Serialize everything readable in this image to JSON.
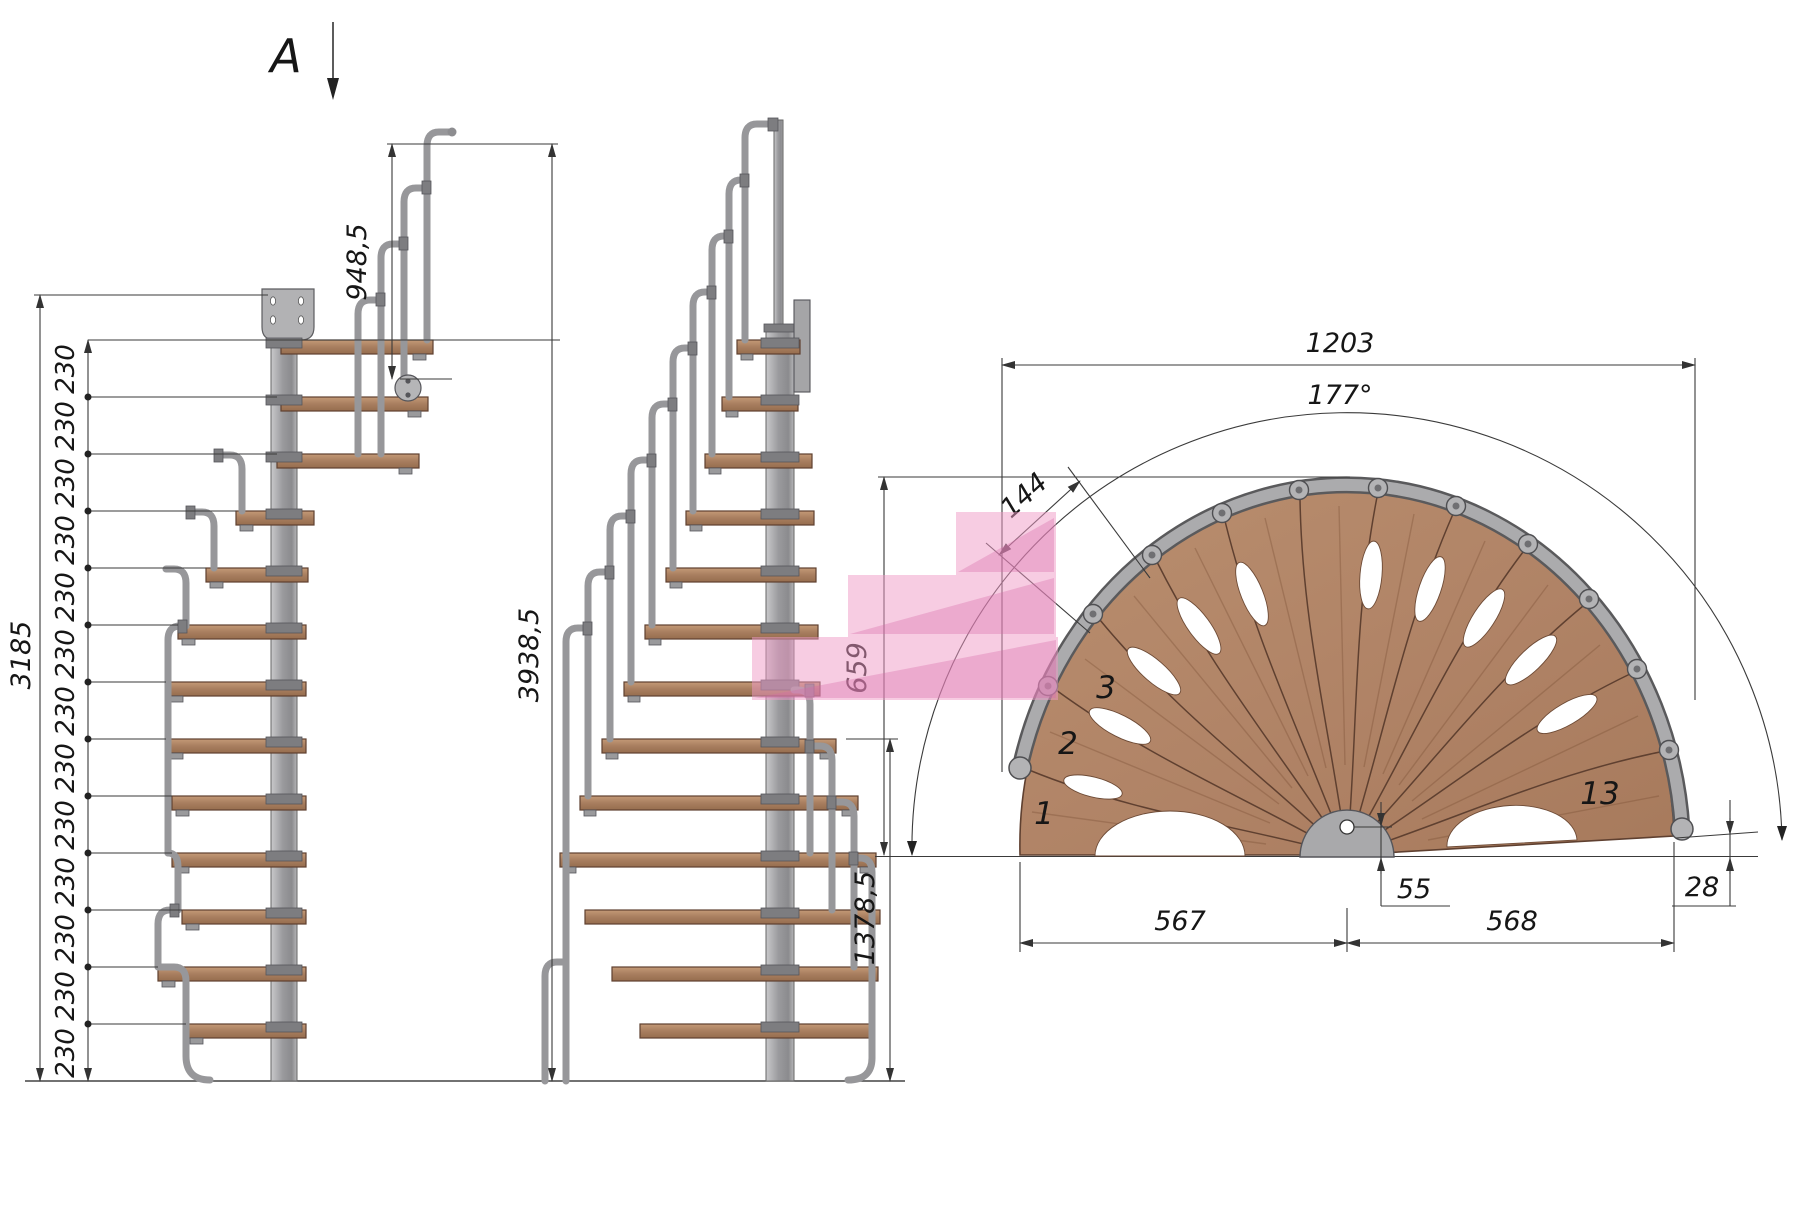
{
  "section_marker": "A",
  "side_view": {
    "overall_height": "3938,5",
    "stair_height": "3185",
    "railing_height": "948,5",
    "riser_labels": [
      "230",
      "230",
      "230",
      "230",
      "230",
      "230",
      "230",
      "230",
      "230",
      "230",
      "230",
      "230",
      "230"
    ]
  },
  "front_view": {
    "lower_height": "1378,5"
  },
  "plan_view": {
    "overall_width": "1203",
    "sweep_angle": "177°",
    "outer_tread_width": "144",
    "depth": "659",
    "center_offset": "55",
    "edge_drop": "28",
    "left_span": "567",
    "right_span": "568",
    "step_numbers": {
      "first": "1",
      "second": "2",
      "third": "3",
      "last": "13"
    }
  },
  "colors": {
    "wood": "#b48a6a",
    "wood_outline": "#5f4030",
    "steel": "#a7a7a9",
    "steel_dark": "#58585a",
    "dimension_line": "#3a3a3a",
    "highlight_pink": "#ef9ac6"
  }
}
